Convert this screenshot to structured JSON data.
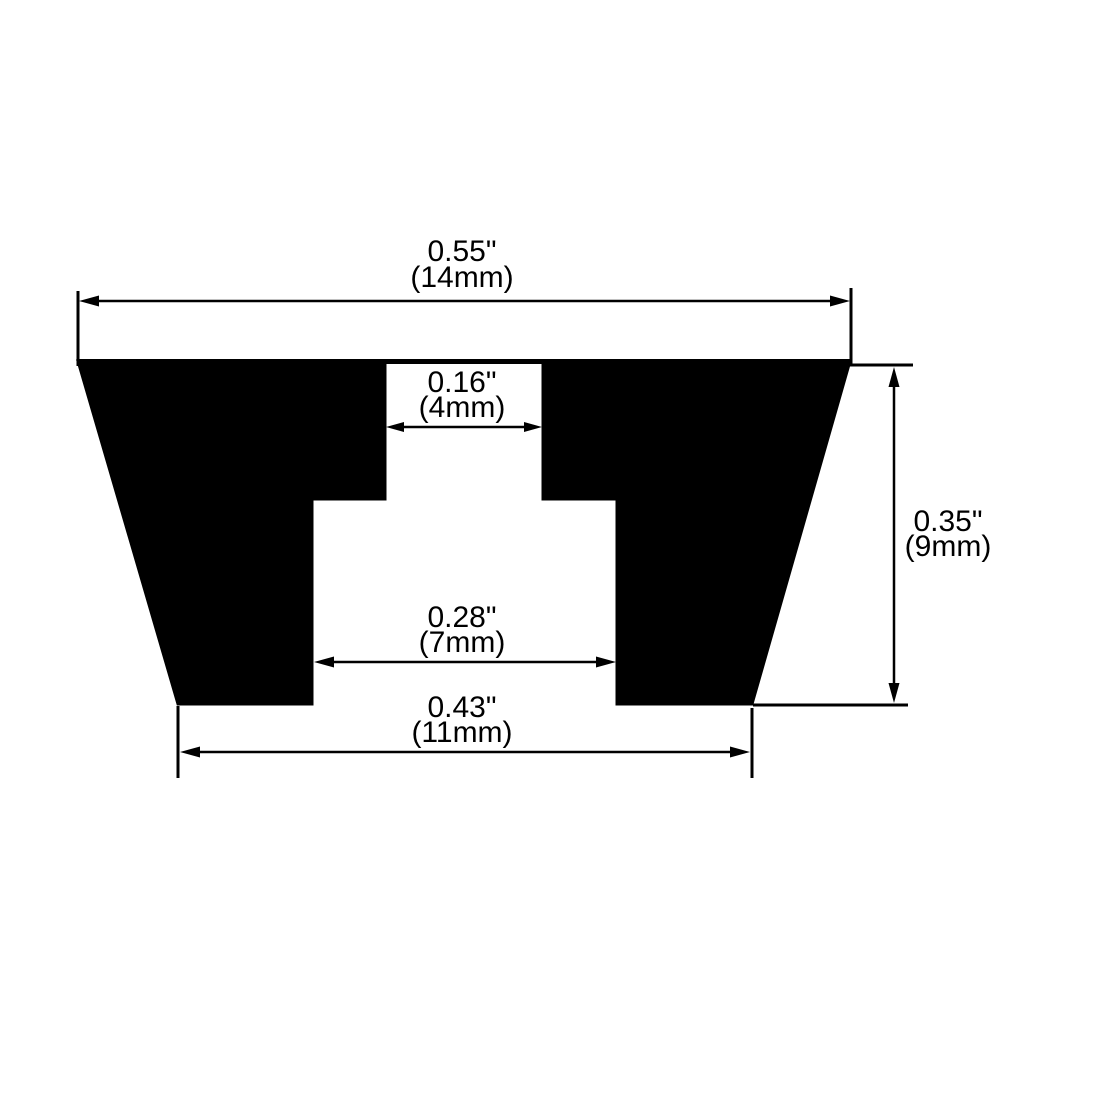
{
  "dimensions": {
    "top_width": {
      "inches": "0.55\"",
      "metric": "(14mm)"
    },
    "top_slot": {
      "inches": "0.16\"",
      "metric": "(4mm)"
    },
    "height": {
      "inches": "0.35\"",
      "metric": "(9mm)"
    },
    "cavity_width": {
      "inches": "0.28\"",
      "metric": "(7mm)"
    },
    "bottom_width": {
      "inches": "0.43\"",
      "metric": "(11mm)"
    }
  },
  "colors": {
    "ink": "#000000",
    "background": "#ffffff"
  }
}
